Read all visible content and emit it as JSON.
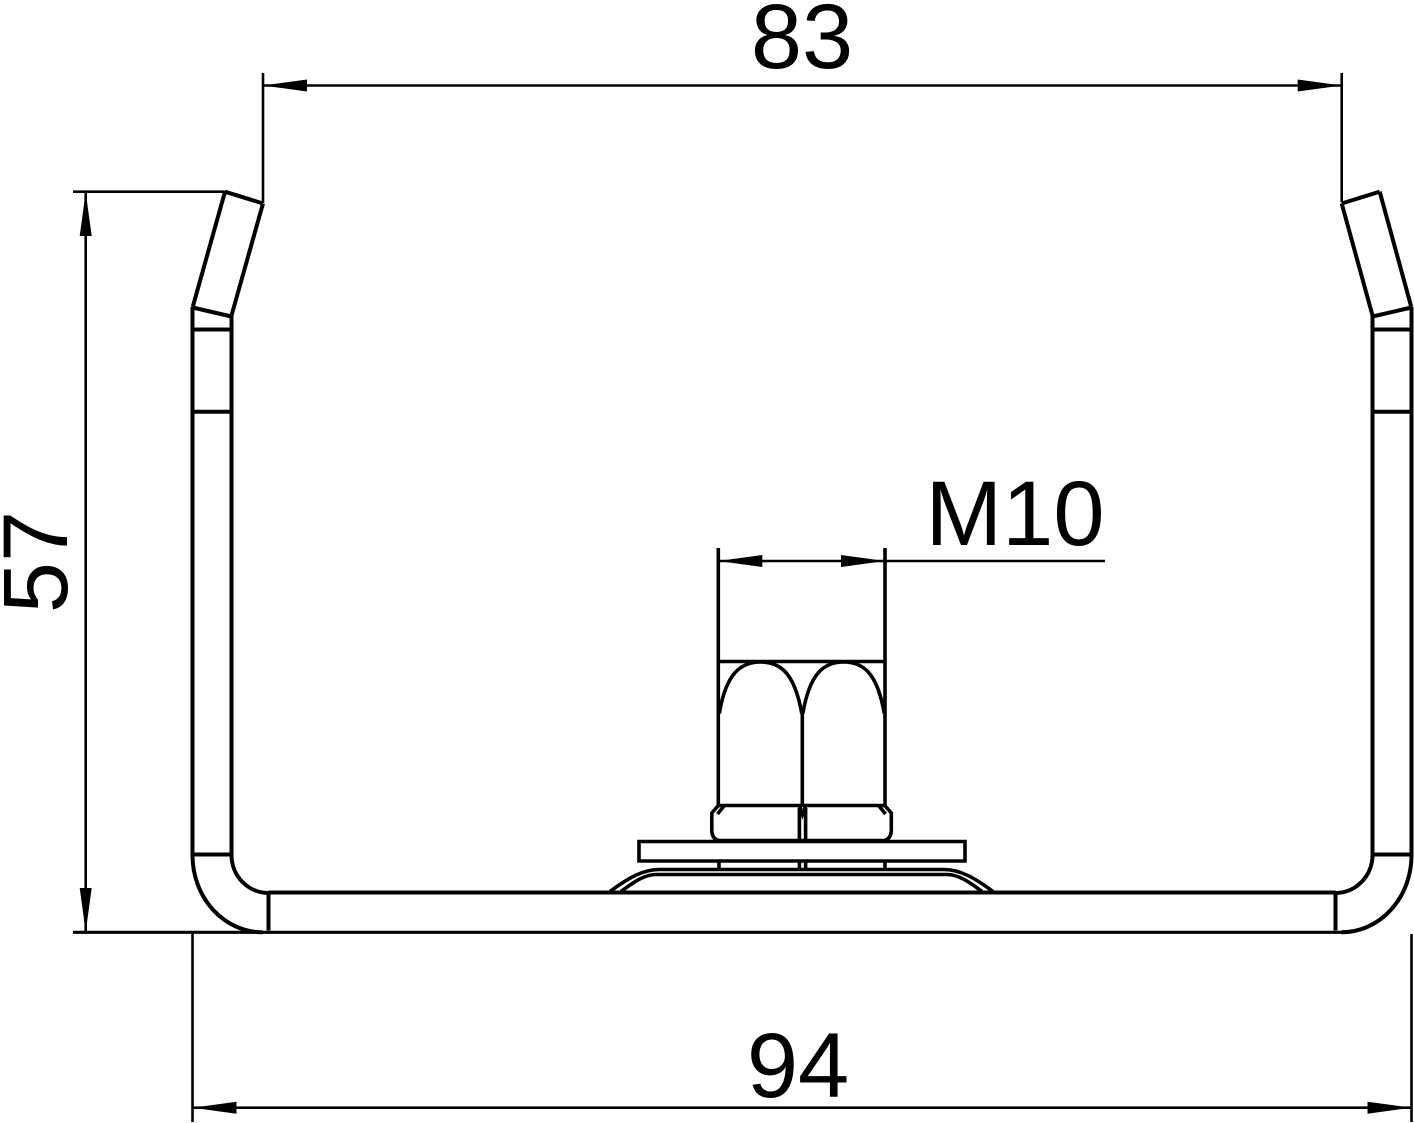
{
  "page": {
    "background_color": "#ffffff",
    "line_color": "#000000"
  },
  "drawing": {
    "dimension_top_width": "83",
    "dimension_height": "57",
    "dimension_bottom_width": "94",
    "thread_label": "M10"
  }
}
